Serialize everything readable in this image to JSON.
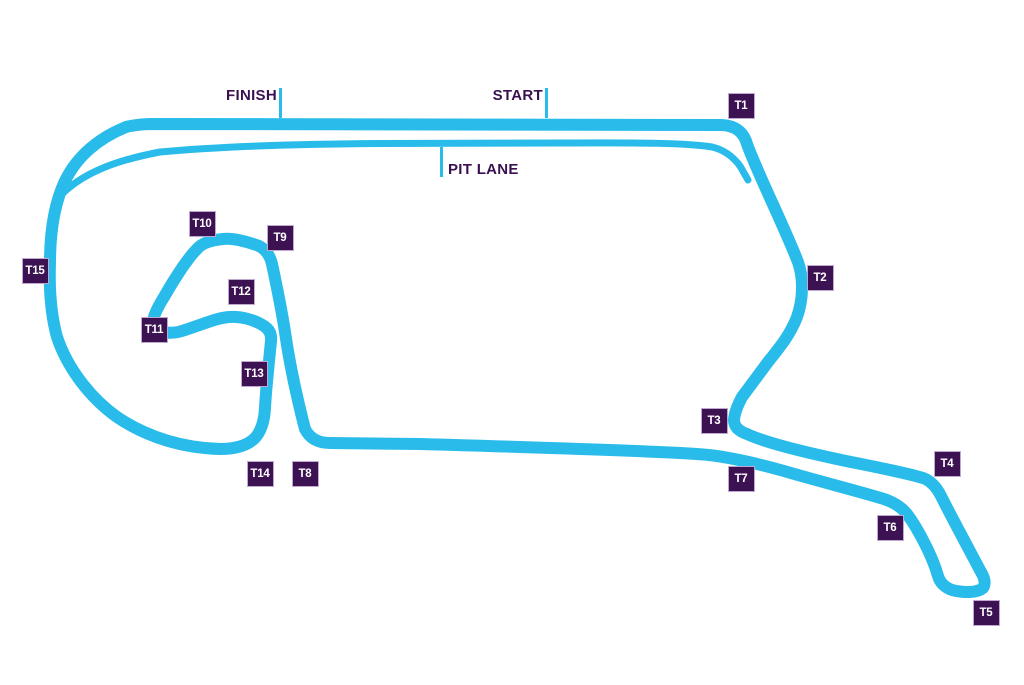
{
  "map_title": "Race circuit map",
  "colors": {
    "track": "#29BCEA",
    "badge_bg": "#3C1253",
    "badge_border": "#BFA9D1",
    "badge_text": "#FFFFFF",
    "label_text": "#3A1150",
    "background": "#FFFFFF"
  },
  "labels": {
    "finish": "FINISH",
    "start": "START",
    "pit_lane": "PIT LANE"
  },
  "turns": [
    {
      "label": "T1",
      "x": 741,
      "y": 106
    },
    {
      "label": "T2",
      "x": 820,
      "y": 278
    },
    {
      "label": "T3",
      "x": 714,
      "y": 421
    },
    {
      "label": "T4",
      "x": 947,
      "y": 464
    },
    {
      "label": "T5",
      "x": 986,
      "y": 613
    },
    {
      "label": "T6",
      "x": 890,
      "y": 528
    },
    {
      "label": "T7",
      "x": 741,
      "y": 479
    },
    {
      "label": "T8",
      "x": 305,
      "y": 474
    },
    {
      "label": "T9",
      "x": 280,
      "y": 238
    },
    {
      "label": "T10",
      "x": 202,
      "y": 224
    },
    {
      "label": "T11",
      "x": 154,
      "y": 330
    },
    {
      "label": "T12",
      "x": 241,
      "y": 292
    },
    {
      "label": "T13",
      "x": 254,
      "y": 374
    },
    {
      "label": "T14",
      "x": 260,
      "y": 474
    },
    {
      "label": "T15",
      "x": 35,
      "y": 271
    }
  ]
}
